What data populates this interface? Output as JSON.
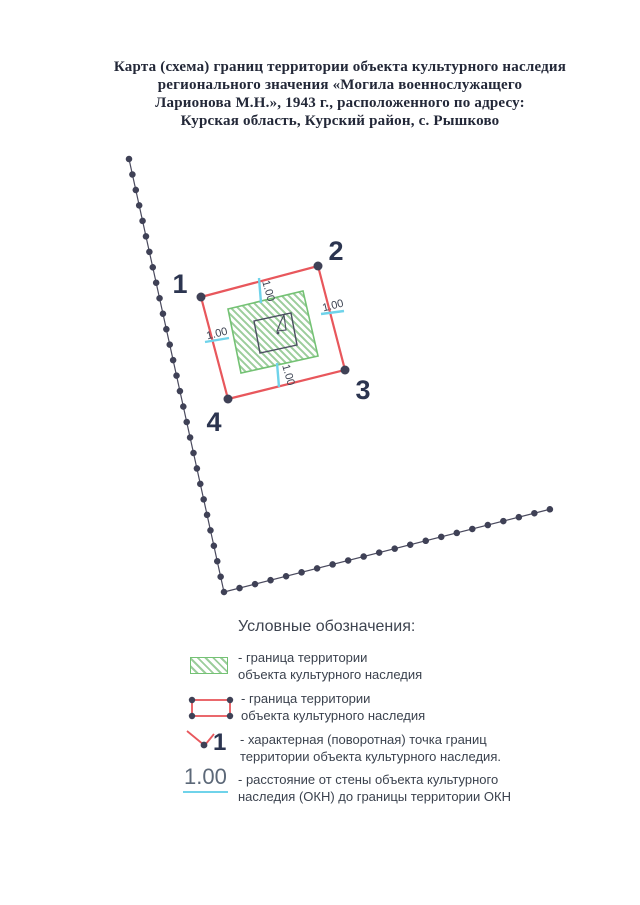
{
  "title": {
    "lines": [
      "Карта (схема) границ территории объекта культурного наследия",
      "регионального значения «Могила военнослужащего",
      "Ларионова М.Н.», 1943 г., расположенного по адресу:",
      "Курская область, Курский район, с. Рышково"
    ]
  },
  "map": {
    "point_labels": {
      "p1": "1",
      "p2": "2",
      "p3": "3",
      "p4": "4"
    },
    "dimensions": {
      "top": "1.00",
      "right": "1.00",
      "left": "1.00",
      "bottom": "1.00"
    }
  },
  "legend": {
    "heading": "Условные обозначения:",
    "items": [
      {
        "symbol": "hatched-area",
        "label_line1": "- граница территории",
        "label_line2": "объекта культурного наследия"
      },
      {
        "symbol": "red-boundary-rectangle",
        "label_line1": "- граница территории",
        "label_line2": "объекта культурного наследия"
      },
      {
        "symbol": "turning-point",
        "symbol_number": "1",
        "label_line1": "- характерная (поворотная) точка границ",
        "label_line2": "территории объекта культурного наследия."
      },
      {
        "symbol": "distance-dimension",
        "symbol_text": "1.00",
        "label_line1": "- расстояние от стены объекта культурного",
        "label_line2": "наследия (ОКН) до границы территории ОКН"
      }
    ]
  },
  "colors": {
    "boundary_red": "#e8575c",
    "hatch_green_border": "#74c274",
    "hatch_green_line": "#9ccd9c",
    "dimension_cyan": "#6fd3ea",
    "point_dot_navy": "#3f4156",
    "label_navy": "#2c3550",
    "title_ink": "#232838"
  }
}
